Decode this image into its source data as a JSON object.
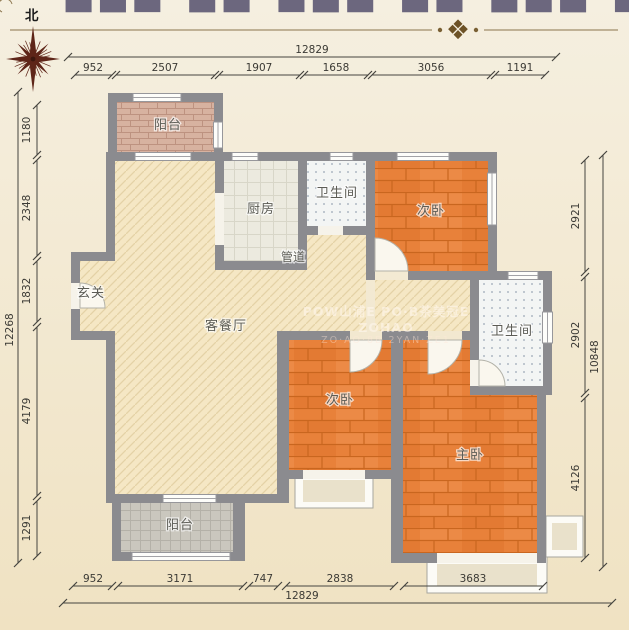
{
  "compass": {
    "north_label": "北"
  },
  "icons": {
    "ornament_glyph": "❖",
    "compass_star": "eight-point-star"
  },
  "watermarks": {
    "top_fragment": "▆▅▇ ▅▆ ▇▅▆ ▆▇ ▅▆▅ ▇▆ ▅▇▅ ▆▅",
    "center_line1": "POW山浦E PO·B茶美冠E ZOHAO",
    "center_line2": "ZO·AO·8B  2YAN·ZE1"
  },
  "rooms": {
    "balcony_top": "阳台",
    "kitchen": "厨房",
    "bath_top": "卫生间",
    "bed_top_right": "次卧",
    "duct": "管道",
    "entry": "玄关",
    "living": "客餐厅",
    "bath_right": "卫生间",
    "bed_bottom": "次卧",
    "master": "主卧",
    "balcony_bottom": "阳台"
  },
  "dimensions": {
    "top": {
      "total": "12829",
      "segments": [
        "952",
        "2507",
        "1907",
        "1658",
        "3056",
        "1191"
      ]
    },
    "bottom": {
      "total": "12829",
      "segments": [
        "952",
        "3171",
        "747",
        "2838",
        "3683"
      ]
    },
    "left": {
      "total": "12268",
      "segments": [
        "1180",
        "2348",
        "1832",
        "4179",
        "1291"
      ]
    },
    "right": {
      "total": "10848",
      "segments": [
        "2921",
        "2902",
        "4126"
      ]
    }
  },
  "colors": {
    "wall": "#8b8b8f",
    "wood_floor": "#e8813a",
    "hatch_floor": "#f5e7c4",
    "background": "#f3ead4"
  }
}
